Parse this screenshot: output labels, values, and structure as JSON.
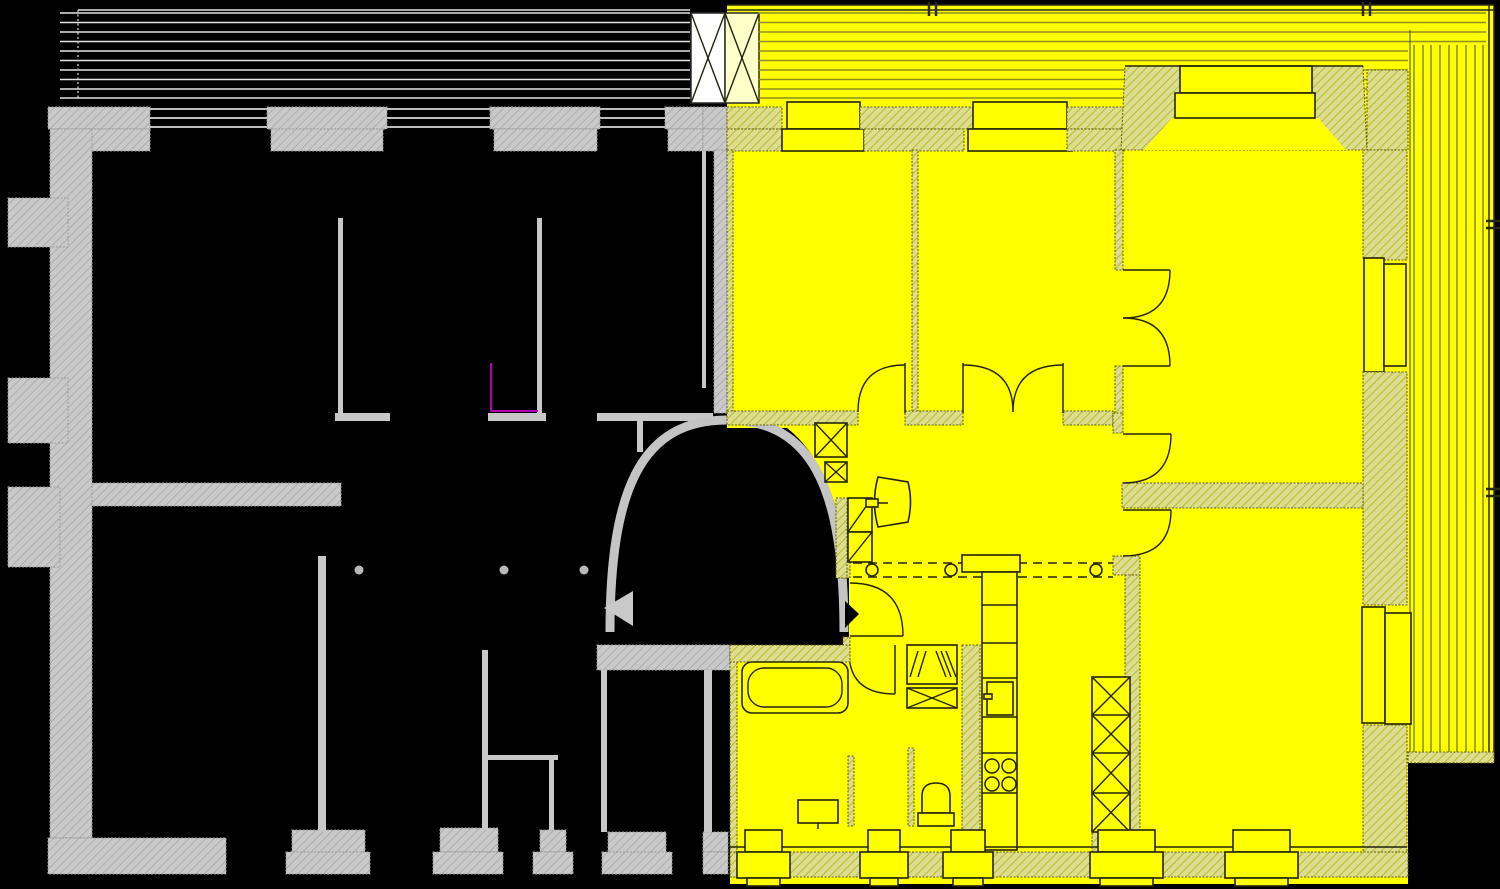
{
  "colors": {
    "background": "#000000",
    "highlight": "#FFFF00",
    "highlight_pale": "#FFFFC9",
    "wall_gray": "#C9C9C9",
    "wall_olive_fill": "#DDDD8F",
    "draw_dark": "#23230A",
    "draw_gray": "#E4E4E4",
    "deck_line_olive": "#8F8F1E",
    "magenta": "#B400B4",
    "arrow_gray": "#C9C9C9",
    "arrow_black": "#000000"
  },
  "plan": {
    "type": "floor-plan",
    "highlighted_apartment": {
      "is_highlighted": true,
      "highlight_color": "#FFFF00",
      "fixtures": [
        "bathtub",
        "toilet",
        "washbasin",
        "bathroom-sink",
        "washing-machine",
        "crossed-cabinet",
        "wardrobe",
        "kitchen-counter",
        "refrigerator",
        "stove"
      ],
      "stove_burners": 4,
      "wardrobe_sections": 4,
      "ceiling_section_markers": 3,
      "door_swings": 9,
      "windows": 6
    },
    "adjacent_apartment": {
      "is_highlighted": false,
      "top_windows": 3,
      "bottom_piers": 5,
      "ceiling_section_markers": 3,
      "has_arched_opening": true
    },
    "balconies": {
      "top_left_deck_lines": 10,
      "top_right_deck_lines": 10,
      "right_side_deck_lines": 9,
      "divider_panels": 2
    },
    "arrows": {
      "left_gray_triangle": 1,
      "right_black_triangle": 1
    }
  }
}
